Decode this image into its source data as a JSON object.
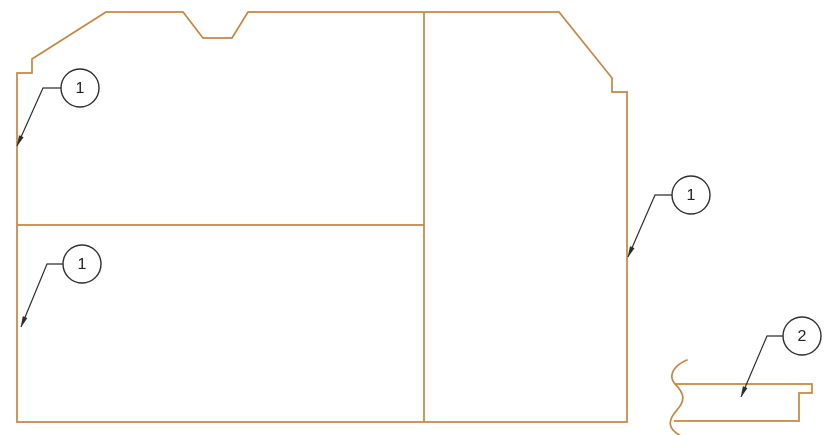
{
  "drawing": {
    "type": "cad-callout-drawing",
    "colors": {
      "background": "#ffffff",
      "outline": "#c6863f",
      "leader": "#2e2e2e",
      "balloon_stroke": "#2e2e2e",
      "balloon_fill": "#ffffff",
      "balloon_text": "#20222c"
    },
    "stroke_widths": {
      "outline": 1.7,
      "leader": 1.2,
      "balloon": 1.4
    },
    "main_part": {
      "outline_points": [
        [
          106,
          12
        ],
        [
          183,
          12
        ],
        [
          203,
          38
        ],
        [
          232,
          38
        ],
        [
          248,
          12
        ],
        [
          559,
          12
        ],
        [
          612,
          78
        ],
        [
          612,
          92
        ],
        [
          627,
          92
        ],
        [
          627,
          422
        ],
        [
          17,
          422
        ],
        [
          17,
          73
        ],
        [
          32,
          73
        ],
        [
          32,
          59
        ]
      ],
      "dividers": [
        {
          "id": "vertical",
          "from": [
            424,
            12
          ],
          "to": [
            424,
            422
          ]
        },
        {
          "id": "horizontal",
          "from": [
            17,
            225
          ],
          "to": [
            424,
            225
          ]
        }
      ]
    },
    "detail_part": {
      "break_line_path": "M 687 360 C 673 366 668 376 675 384 C 684 393 686 400 677 410 C 667 421 668 429 681 436",
      "profile_points": [
        [
          675,
          384
        ],
        [
          812,
          384
        ],
        [
          812,
          393
        ],
        [
          799,
          393
        ],
        [
          799,
          421
        ],
        [
          674,
          421
        ]
      ]
    },
    "balloons": [
      {
        "label": "1",
        "cx": 80,
        "cy": 88,
        "r": 19,
        "bend": [
          43,
          88
        ],
        "tip": [
          17,
          146
        ]
      },
      {
        "label": "1",
        "cx": 82,
        "cy": 264,
        "r": 19,
        "bend": [
          47,
          264
        ],
        "tip": [
          21,
          327
        ]
      },
      {
        "label": "1",
        "cx": 691,
        "cy": 195,
        "r": 19,
        "bend": [
          655,
          195
        ],
        "tip": [
          628,
          257
        ]
      },
      {
        "label": "2",
        "cx": 802,
        "cy": 336,
        "r": 19,
        "bend": [
          767,
          336
        ],
        "tip": [
          741,
          397
        ]
      }
    ],
    "arrowhead": {
      "length": 10.5,
      "half_width": 2.2
    }
  }
}
